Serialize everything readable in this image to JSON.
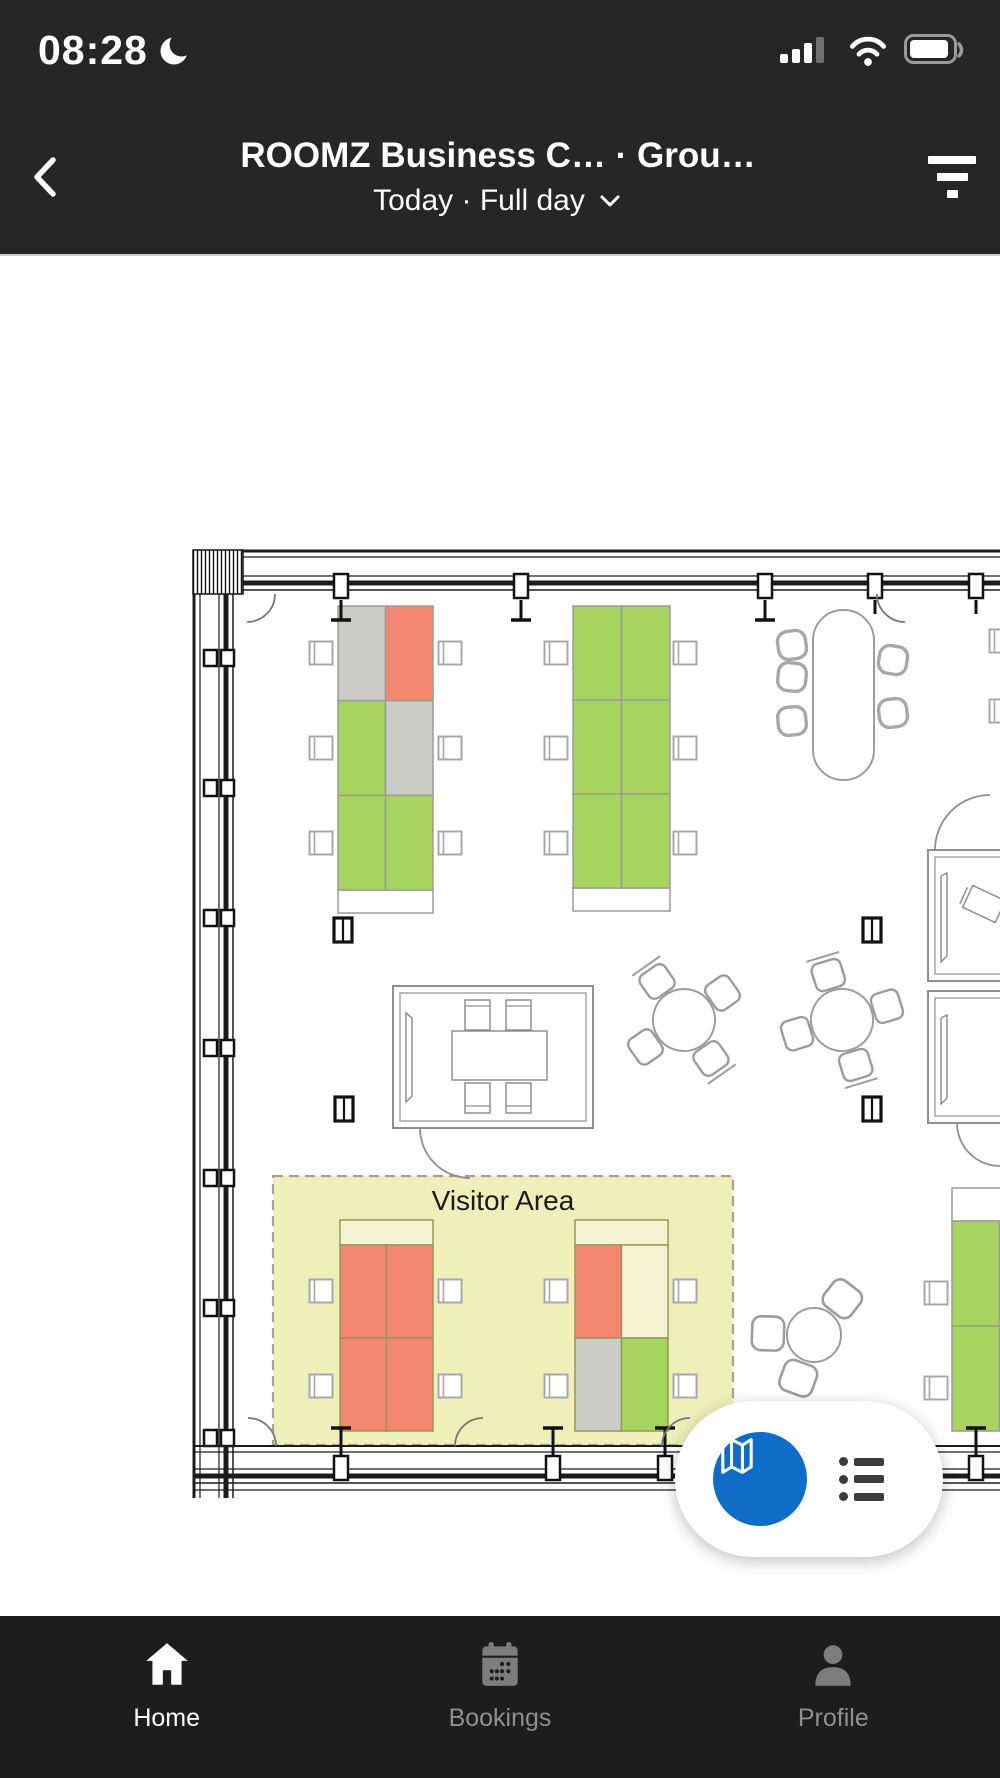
{
  "status_bar": {
    "time": "08:28",
    "moon_icon": "do-not-disturb-moon",
    "signal_icon": "cellular-signal",
    "wifi_icon": "wifi",
    "battery_icon": "battery"
  },
  "header": {
    "back_icon": "chevron-left",
    "title": "ROOMZ Business C…  ·  Grou…",
    "subtitle": "Today · Full day",
    "subtitle_chevron_icon": "chevron-down",
    "filter_icon": "filter"
  },
  "floor_plan": {
    "visitor_area_label": "Visitor Area",
    "status_colors": {
      "free": "#a6d45f",
      "booked": "#f4876f",
      "blocked": "#cbcbc7",
      "none": "#f4f3d2"
    },
    "desk_banks": [
      {
        "name": "bank-top-left",
        "x": 338,
        "y": 350,
        "cols": 2,
        "rows": 3,
        "cell_w": 47.5,
        "cell_h": 94.7,
        "stroke": "#9b9b9b",
        "cap": {
          "y": 634,
          "h": 23,
          "fill": "#ffffff"
        },
        "cells": [
          "blocked",
          "booked",
          "free",
          "blocked",
          "free",
          "free"
        ]
      },
      {
        "name": "bank-top-middle",
        "x": 573,
        "y": 350,
        "cols": 2,
        "rows": 3,
        "cell_w": 48.5,
        "cell_h": 94,
        "stroke": "#9b9b9b",
        "cap": {
          "y": 632,
          "h": 23,
          "fill": "#ffffff"
        },
        "cells": [
          "free",
          "free",
          "free",
          "free",
          "free",
          "free"
        ]
      },
      {
        "name": "visitor-bank-left",
        "x": 340,
        "y": 989,
        "cols": 2,
        "rows": 2,
        "cell_w": 46.5,
        "cell_h": 93,
        "stroke": "#97975a",
        "cap": {
          "y": 964,
          "h": 25,
          "fill": "#f4f3d2"
        },
        "cells": [
          "booked",
          "booked",
          "booked",
          "booked"
        ]
      },
      {
        "name": "visitor-bank-right",
        "x": 575,
        "y": 989,
        "cols": 2,
        "rows": 2,
        "cell_w": 46.5,
        "cell_h": 93,
        "stroke": "#97975a",
        "cap": {
          "y": 964,
          "h": 25,
          "fill": "#f4f3d2"
        },
        "cells": [
          "booked",
          "none",
          "blocked",
          "free"
        ]
      },
      {
        "name": "bank-bottom-right-edge",
        "x": 952,
        "y": 965,
        "cols": 2,
        "rows": 2,
        "cell_w": 47.5,
        "cell_h": 105,
        "stroke": "#9b9b9b",
        "cap": {
          "y": 932,
          "h": 33,
          "fill": "#ffffff"
        },
        "cells": [
          "free",
          "free",
          "free",
          "free"
        ]
      }
    ]
  },
  "fab": {
    "map_button_color": "#0d6dc8",
    "map_icon": "map",
    "list_icon": "list"
  },
  "bottom_nav": {
    "items": [
      {
        "label": "Home",
        "icon": "home",
        "active": true
      },
      {
        "label": "Bookings",
        "icon": "calendar",
        "active": false
      },
      {
        "label": "Profile",
        "icon": "person",
        "active": false
      }
    ]
  }
}
